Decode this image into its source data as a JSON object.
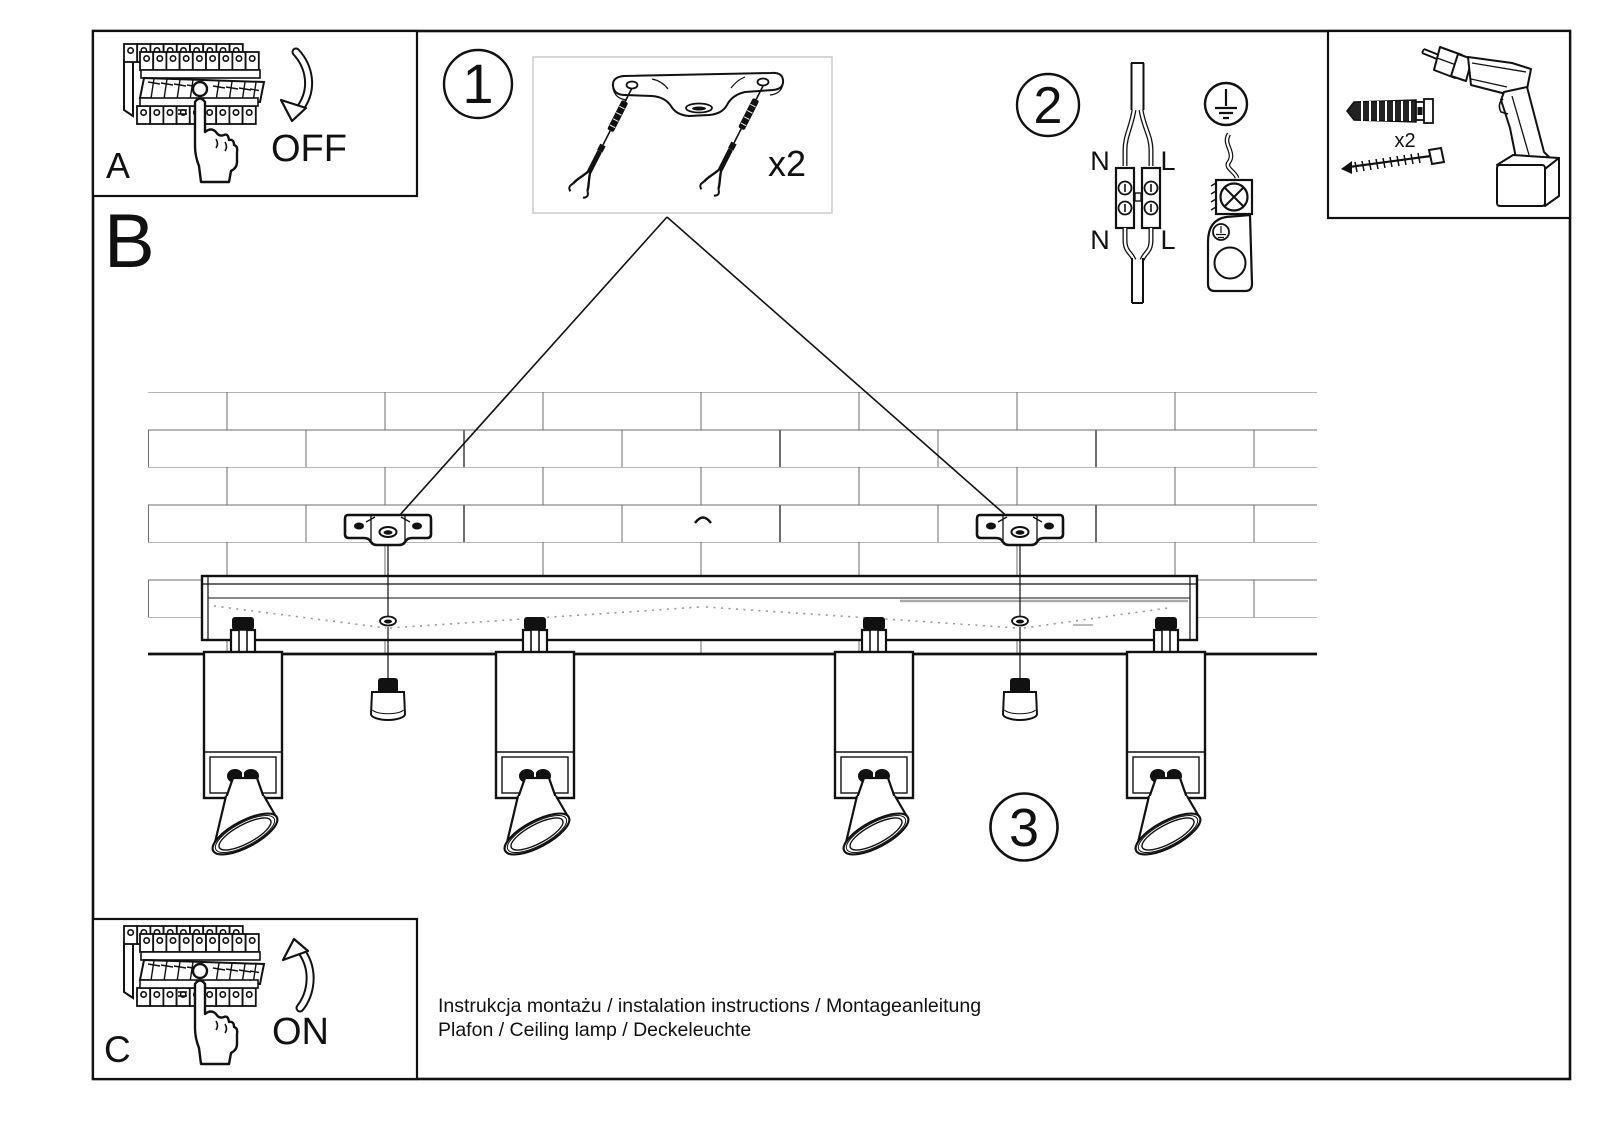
{
  "footer": {
    "line1": "Instrukcja montażu / instalation instructions / Montageanleitung",
    "line2": "Plafon / Ceiling lamp / Deckeleuchte"
  },
  "steps": {
    "a": {
      "label": "A",
      "state": "OFF"
    },
    "b": {
      "label": "B"
    },
    "c": {
      "label": "C",
      "state": "ON"
    },
    "s1": {
      "number": "1",
      "quantity": "x2"
    },
    "s2": {
      "number": "2",
      "wire_n": "N",
      "wire_l": "L"
    },
    "s3": {
      "number": "3"
    }
  },
  "tools": {
    "plug_quantity": "x2"
  },
  "colors": {
    "ink": "#111111",
    "paper": "#ffffff",
    "detail_border": "#cccccc",
    "brick": "#666666"
  }
}
